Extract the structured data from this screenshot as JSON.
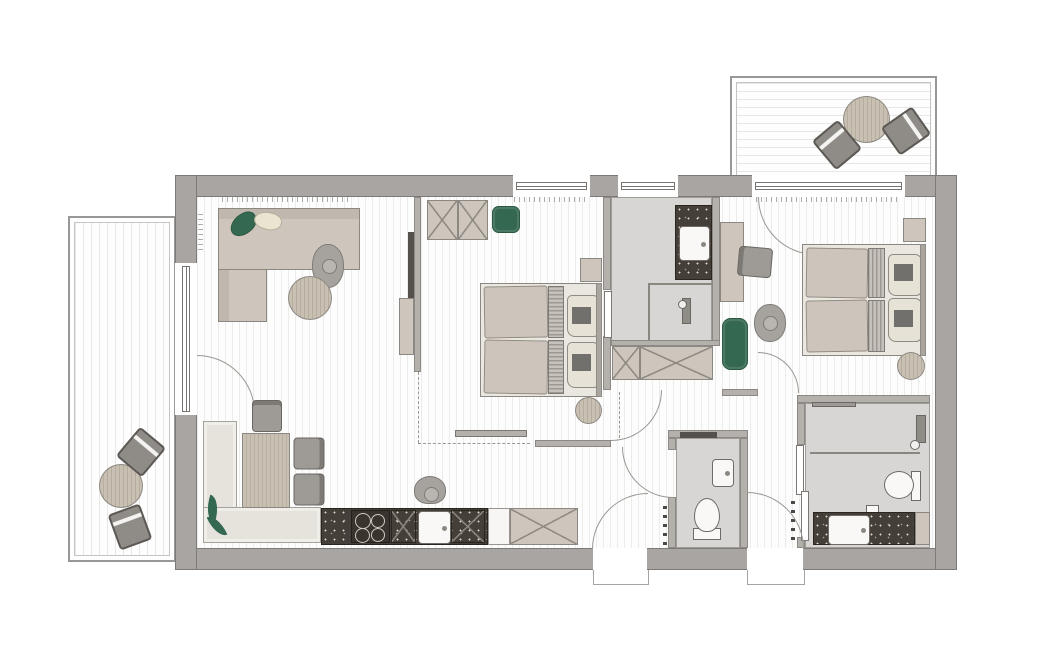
{
  "meta": {
    "type": "floor-plan",
    "title": "apartment-floor-plan-top-view",
    "visible_text": []
  },
  "palette": {
    "wall": "#a8a5a2",
    "wall_edge": "#6f6c68",
    "interior_wall": "#b4b1ad",
    "floor_line": "#ececea",
    "deck_line": "#e8e7e5",
    "furniture_beige": "#cec6bc",
    "bench_light": "#e6e3dd",
    "outline": "#8b8781",
    "accent_green": "#356851",
    "counter_dark": "#453f39",
    "bath_floor": "#d7d6d4",
    "fixture_white": "#f9f8f6",
    "chair_gray": "#9e9b96",
    "wood": "#c8c0b2",
    "person_gray": "#a6a39f",
    "pillow_cream": "#e9e5d1",
    "mattress": "#cdc5bb"
  },
  "rooms": [
    {
      "name": "living-room",
      "furniture": [
        "corner-sofa",
        "green-pillow",
        "cream-pillow",
        "round-coffee-table",
        "tv",
        "tv-lowboard",
        "person-sitting",
        "balcony-door"
      ]
    },
    {
      "name": "dining-kitchen",
      "furniture": [
        "corner-bench",
        "dining-table",
        "head-chair",
        "side-chair-1",
        "side-chair-2",
        "potted-plant",
        "kitchen-counter-dark",
        "cooktop-4-burner",
        "kitchen-sink",
        "base-cabinets-x",
        "tall-cabinet-x",
        "person-standing"
      ]
    },
    {
      "name": "bedroom-1",
      "furniture": [
        "wardrobe-2-door",
        "green-armchair",
        "double-bed",
        "two-pillows",
        "nightstand",
        "round-stool",
        "window"
      ]
    },
    {
      "name": "bathroom-1-ensuite",
      "furniture": [
        "vanity-dark-counter",
        "washbasin",
        "walk-in-shower",
        "glass-partition",
        "sliding-door",
        "window"
      ]
    },
    {
      "name": "hallway",
      "furniture": [
        "wardrobe-x",
        "radiator",
        "door-to-bedroom-1",
        "door-to-wc",
        "two-exterior-doors"
      ]
    },
    {
      "name": "wc",
      "furniture": [
        "toilet",
        "hand-basin",
        "shelf"
      ]
    },
    {
      "name": "bedroom-2",
      "furniture": [
        "double-bed",
        "two-pillows",
        "nightstand",
        "round-stool",
        "desk",
        "desk-chair",
        "green-bench",
        "person-standing",
        "balcony-door"
      ]
    },
    {
      "name": "bathroom-2",
      "furniture": [
        "walk-in-shower",
        "toilet",
        "vanity-dark-counter",
        "washbasin",
        "sliding-door"
      ]
    },
    {
      "name": "balcony-top-right",
      "furniture": [
        "round-table",
        "chair-1",
        "chair-2"
      ]
    },
    {
      "name": "balcony-left",
      "furniture": [
        "round-table",
        "chair-1",
        "chair-2"
      ]
    }
  ]
}
